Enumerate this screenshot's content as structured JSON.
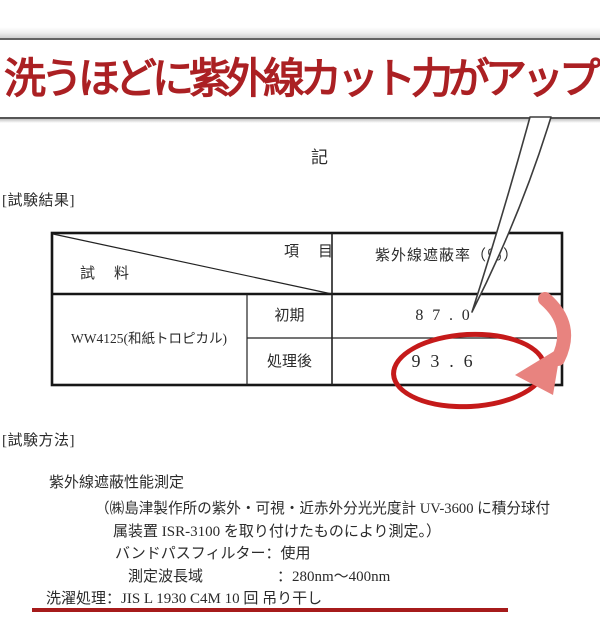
{
  "headline": {
    "text": "洗うほどに紫外線カット力がアップ",
    "color": "#ab2023"
  },
  "memo_mark": "記",
  "sections": {
    "results_label": "[試験結果]",
    "method_label": "[試験方法]"
  },
  "table": {
    "header": {
      "item_label": "項　目",
      "sample_label": "試　料",
      "value_header": "紫外線遮蔽率（％）"
    },
    "sample_name": "WW4125(和紙トロピカル)",
    "rows": [
      {
        "label": "初期",
        "value": "87.0"
      },
      {
        "label": "処理後",
        "value": "93.6",
        "highlighted": true
      }
    ]
  },
  "method": {
    "title": "紫外線遮蔽性能測定",
    "line1": "（㈱島津製作所の紫外・可視・近赤外分光光度計 UV-3600 に積分球付",
    "line2": "属装置 ISR-3100 を取り付けたものにより測定。）",
    "bandpass": "バンドパスフィルター：使用",
    "wavelength_label": "測定波長域",
    "wavelength_value": "：280nm～400nm",
    "washing": "洗濯処理：JIS L 1930 C4M 10 回 吊り干し"
  },
  "annotations": {
    "circle_color": "#c51a1a",
    "arrow_color": "#e8837f",
    "underline_color": "#a61b1b",
    "highlighted_value": "93.6"
  }
}
